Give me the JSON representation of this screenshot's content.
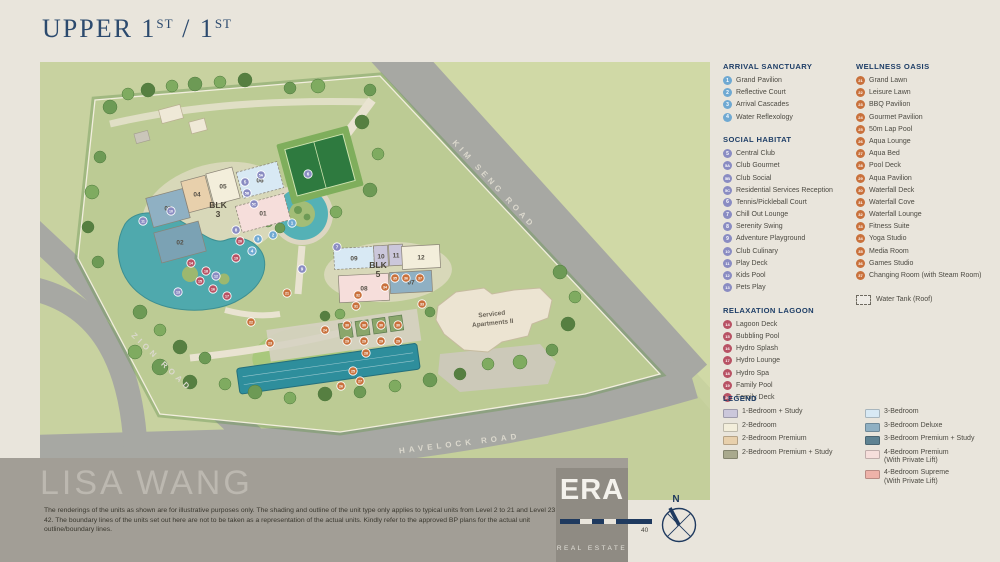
{
  "title": {
    "part1": "Upper 1",
    "sup1": "st",
    "part2": " / 1",
    "sup2": "st"
  },
  "colors": {
    "arrival": "#6fa9d2",
    "social": "#8a8cc2",
    "relax": "#b85264",
    "wellness": "#c9713c"
  },
  "sections": [
    {
      "id": "arrival",
      "title": "ARRIVAL SANCTUARY",
      "items": [
        {
          "num": "1",
          "label": "Grand Pavilion"
        },
        {
          "num": "2",
          "label": "Reflective Court"
        },
        {
          "num": "3",
          "label": "Arrival Cascades"
        },
        {
          "num": "4",
          "label": "Water Reflexology"
        }
      ]
    },
    {
      "id": "social",
      "title": "SOCIAL HABITAT",
      "items": [
        {
          "num": "5",
          "label": "Central Club"
        },
        {
          "num": "5A",
          "label": "Club Gourmet"
        },
        {
          "num": "5B",
          "label": "Club Social"
        },
        {
          "num": "5C",
          "label": "Residential Services Reception"
        },
        {
          "num": "6",
          "label": "Tennis/Pickleball Court"
        },
        {
          "num": "7",
          "label": "Chill Out Lounge"
        },
        {
          "num": "8",
          "label": "Serenity Swing"
        },
        {
          "num": "9",
          "label": "Adventure Playground"
        },
        {
          "num": "10",
          "label": "Club Culinary"
        },
        {
          "num": "11",
          "label": "Play Deck"
        },
        {
          "num": "12",
          "label": "Kids Pool"
        },
        {
          "num": "13",
          "label": "Pets Play"
        }
      ]
    },
    {
      "id": "relax",
      "title": "RELAXATION LAGOON",
      "items": [
        {
          "num": "14",
          "label": "Lagoon Deck"
        },
        {
          "num": "15",
          "label": "Bubbling Pool"
        },
        {
          "num": "16",
          "label": "Hydro Splash"
        },
        {
          "num": "17",
          "label": "Hydro Lounge"
        },
        {
          "num": "18",
          "label": "Hydro Spa"
        },
        {
          "num": "19",
          "label": "Family Pool"
        },
        {
          "num": "20",
          "label": "Family Deck"
        }
      ]
    },
    {
      "id": "wellness",
      "title": "WELLNESS OASIS",
      "items": [
        {
          "num": "21",
          "label": "Grand Lawn"
        },
        {
          "num": "22",
          "label": "Leisure Lawn"
        },
        {
          "num": "23",
          "label": "BBQ Pavilion"
        },
        {
          "num": "24",
          "label": "Gourmet Pavilion"
        },
        {
          "num": "25",
          "label": "50m Lap Pool"
        },
        {
          "num": "26",
          "label": "Aqua Lounge"
        },
        {
          "num": "27",
          "label": "Aqua Bed"
        },
        {
          "num": "28",
          "label": "Pool Deck"
        },
        {
          "num": "29",
          "label": "Aqua Pavilion"
        },
        {
          "num": "30",
          "label": "Waterfall Deck"
        },
        {
          "num": "31",
          "label": "Waterfall Cove"
        },
        {
          "num": "32",
          "label": "Waterfall Lounge"
        },
        {
          "num": "33",
          "label": "Fitness Suite"
        },
        {
          "num": "34",
          "label": "Yoga Studio"
        },
        {
          "num": "35",
          "label": "Media Room"
        },
        {
          "num": "36",
          "label": "Games Studio"
        },
        {
          "num": "37",
          "label": "Changing Room (with Steam Room)"
        }
      ]
    }
  ],
  "water_tank_label": "Water Tank (Roof)",
  "unit_legend": {
    "title": "LEGEND",
    "columns": [
      [
        {
          "color": "#cbc7db",
          "label": "1-Bedroom + Study"
        },
        {
          "color": "#f3eedb",
          "label": "2-Bedroom"
        },
        {
          "color": "#e8d0ac",
          "label": "2-Bedroom Premium"
        },
        {
          "color": "#a9a98d",
          "label": "2-Bedroom Premium + Study"
        }
      ],
      [
        {
          "color": "#d8e9f4",
          "label": "3-Bedroom"
        },
        {
          "color": "#8fb0c3",
          "label": "3-Bedroom Deluxe"
        },
        {
          "color": "#5e8292",
          "label": "3-Bedroom Premium + Study"
        },
        {
          "color": "#f6dedb",
          "label": "4-Bedroom Premium",
          "sub": "(With Private Lift)"
        },
        {
          "color": "#eeb2a9",
          "label": "4-Bedroom Supreme",
          "sub": "(With Private Lift)"
        }
      ]
    ]
  },
  "map": {
    "road_labels": [
      {
        "label": "KIM SENG ROAD",
        "x": 452,
        "y": 124,
        "rotate": 47
      },
      {
        "label": "ZION ROAD",
        "x": 120,
        "y": 302,
        "rotate": 44
      },
      {
        "label": "HAVELOCK ROAD",
        "x": 420,
        "y": 384,
        "rotate": -7
      }
    ],
    "blocks": [
      {
        "line1": "BLK",
        "line2": "3",
        "x": 178,
        "y": 146
      },
      {
        "line1": "BLK",
        "line2": "5",
        "x": 338,
        "y": 206
      }
    ],
    "serviced_apartments": {
      "line1": "Serviced",
      "line2": "Apartments II",
      "x": 452,
      "y": 254,
      "rotate": -6
    },
    "units": [
      {
        "label": "03",
        "cx": 128,
        "cy": 146,
        "w": 38,
        "h": 30,
        "rot": -15,
        "fill": "#8fb0c3"
      },
      {
        "label": "04",
        "cx": 157,
        "cy": 132,
        "w": 25,
        "h": 32,
        "rot": -15,
        "fill": "#e8d0ac"
      },
      {
        "label": "05",
        "cx": 183,
        "cy": 124,
        "w": 27,
        "h": 32,
        "rot": -15,
        "fill": "#f3eedb"
      },
      {
        "label": "06",
        "cx": 220,
        "cy": 118,
        "w": 42,
        "h": 27,
        "rot": -15,
        "fill": "#d8e9f4",
        "dash": true
      },
      {
        "label": "01",
        "cx": 223,
        "cy": 151,
        "w": 50,
        "h": 27,
        "rot": -15,
        "fill": "#f6dedb",
        "dash": true
      },
      {
        "label": "02",
        "cx": 140,
        "cy": 180,
        "w": 46,
        "h": 31,
        "rot": -15,
        "fill": "#7ba2b4"
      },
      {
        "label": "09",
        "cx": 314,
        "cy": 196,
        "w": 40,
        "h": 21,
        "rot": -3,
        "fill": "#d8e9f4",
        "dash": true
      },
      {
        "label": "10",
        "cx": 341,
        "cy": 194,
        "w": 14,
        "h": 21,
        "rot": -3,
        "fill": "#cbc7db"
      },
      {
        "label": "11",
        "cx": 356,
        "cy": 193,
        "w": 14,
        "h": 21,
        "rot": -3,
        "fill": "#cbc7db"
      },
      {
        "label": "12",
        "cx": 381,
        "cy": 195,
        "w": 38,
        "h": 23,
        "rot": -3,
        "fill": "#f3eedb"
      },
      {
        "label": "07",
        "cx": 371,
        "cy": 220,
        "w": 42,
        "h": 21,
        "rot": -3,
        "fill": "#8fb0c3"
      },
      {
        "label": "08",
        "cx": 324,
        "cy": 226,
        "w": 50,
        "h": 27,
        "rot": -3,
        "fill": "#f6dedb"
      }
    ],
    "markers": [
      {
        "n": "1",
        "c": "arrival",
        "x": 252,
        "y": 161
      },
      {
        "n": "2",
        "c": "arrival",
        "x": 233,
        "y": 173
      },
      {
        "n": "3",
        "c": "arrival",
        "x": 218,
        "y": 177
      },
      {
        "n": "4",
        "c": "arrival",
        "x": 212,
        "y": 189
      },
      {
        "n": "5",
        "c": "social",
        "x": 205,
        "y": 120
      },
      {
        "n": "5A",
        "c": "social",
        "x": 221,
        "y": 113
      },
      {
        "n": "5B",
        "c": "social",
        "x": 207,
        "y": 131
      },
      {
        "n": "5C",
        "c": "social",
        "x": 214,
        "y": 142
      },
      {
        "n": "6",
        "c": "social",
        "x": 268,
        "y": 112
      },
      {
        "n": "7",
        "c": "social",
        "x": 297,
        "y": 185
      },
      {
        "n": "8",
        "c": "social",
        "x": 196,
        "y": 168
      },
      {
        "n": "9",
        "c": "social",
        "x": 262,
        "y": 207
      },
      {
        "n": "10",
        "c": "social",
        "x": 131,
        "y": 149
      },
      {
        "n": "11",
        "c": "social",
        "x": 103,
        "y": 159
      },
      {
        "n": "12",
        "c": "social",
        "x": 176,
        "y": 214
      },
      {
        "n": "13",
        "c": "social",
        "x": 138,
        "y": 230
      },
      {
        "n": "14",
        "c": "relax",
        "x": 151,
        "y": 201
      },
      {
        "n": "15",
        "c": "relax",
        "x": 160,
        "y": 219
      },
      {
        "n": "16",
        "c": "relax",
        "x": 173,
        "y": 227
      },
      {
        "n": "17",
        "c": "relax",
        "x": 187,
        "y": 234
      },
      {
        "n": "18",
        "c": "relax",
        "x": 166,
        "y": 209
      },
      {
        "n": "19",
        "c": "relax",
        "x": 196,
        "y": 196
      },
      {
        "n": "20",
        "c": "relax",
        "x": 200,
        "y": 179
      },
      {
        "n": "21",
        "c": "wellness",
        "x": 247,
        "y": 231
      },
      {
        "n": "22",
        "c": "wellness",
        "x": 211,
        "y": 260
      },
      {
        "n": "23",
        "c": "wellness",
        "x": 230,
        "y": 281
      },
      {
        "n": "24",
        "c": "wellness",
        "x": 285,
        "y": 268
      },
      {
        "n": "25",
        "c": "wellness",
        "x": 313,
        "y": 309
      },
      {
        "n": "26",
        "c": "wellness",
        "x": 301,
        "y": 324
      },
      {
        "n": "27",
        "c": "wellness",
        "x": 320,
        "y": 319
      },
      {
        "n": "28",
        "c": "wellness",
        "x": 326,
        "y": 291
      },
      {
        "n": "29",
        "c": "wellness",
        "x": 307,
        "y": 279
      },
      {
        "n": "29",
        "c": "wellness",
        "x": 324,
        "y": 279
      },
      {
        "n": "29",
        "c": "wellness",
        "x": 341,
        "y": 279
      },
      {
        "n": "29",
        "c": "wellness",
        "x": 358,
        "y": 279
      },
      {
        "n": "30",
        "c": "wellness",
        "x": 307,
        "y": 263
      },
      {
        "n": "30",
        "c": "wellness",
        "x": 324,
        "y": 263
      },
      {
        "n": "30",
        "c": "wellness",
        "x": 341,
        "y": 263
      },
      {
        "n": "30",
        "c": "wellness",
        "x": 358,
        "y": 263
      },
      {
        "n": "31",
        "c": "wellness",
        "x": 316,
        "y": 244
      },
      {
        "n": "32",
        "c": "wellness",
        "x": 318,
        "y": 233
      },
      {
        "n": "33",
        "c": "wellness",
        "x": 382,
        "y": 242
      },
      {
        "n": "34",
        "c": "wellness",
        "x": 345,
        "y": 225
      },
      {
        "n": "35",
        "c": "wellness",
        "x": 355,
        "y": 216
      },
      {
        "n": "36",
        "c": "wellness",
        "x": 366,
        "y": 216
      },
      {
        "n": "37",
        "c": "wellness",
        "x": 380,
        "y": 216
      }
    ]
  },
  "footer": {
    "watermark": "LISA WANG",
    "disclaimer": "The renderings of the units as shown are for illustrative purposes only. The shading and outline of the unit type only applies to typical units from Level 2 to 21 and Level 23 to 42. The boundary lines of the units set out here are not to be taken as a representation of the actual units. Kindly refer to the approved BP plans for the actual unit outline/boundary lines.",
    "logo_main": "ERA",
    "logo_sub": "REAL ESTATE",
    "scale_end_label": "40",
    "compass_label": "N"
  }
}
